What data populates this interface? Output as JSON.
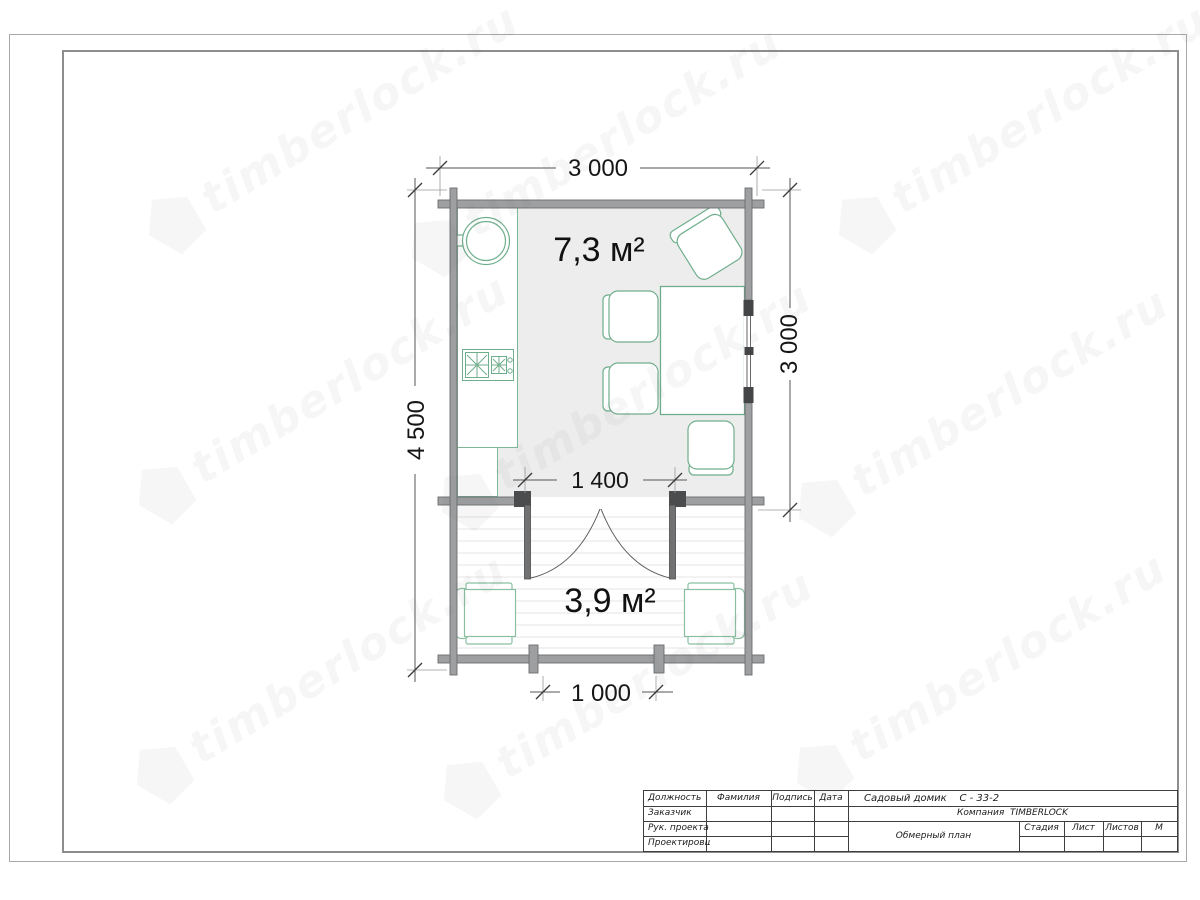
{
  "watermark": {
    "text": "timberlock.ru"
  },
  "plan": {
    "dim_width_top": "3 000",
    "dim_height_total": "4 500",
    "dim_height_room": "3 000",
    "dim_door_opening": "1 400",
    "dim_terrace_opening": "1 000",
    "area_room": "7,3 м²",
    "area_terrace": "3,9 м²"
  },
  "title_block": {
    "col_position": "Должность",
    "col_surname": "Фамилия",
    "col_signature": "Подпись",
    "col_date": "Дата",
    "row_customer": "Заказчик",
    "row_project_lead": "Рук. проекта",
    "row_designer": "Проектировщик",
    "project_title": "Садовый домик    С - 33-2",
    "company": "Компания  TIMBERLOCK",
    "drawing_type": "Обмерный план",
    "col_stage": "Стадия",
    "col_sheet": "Лист",
    "col_sheets": "Листов",
    "col_scale": "М"
  },
  "colors": {
    "wall_fill": "#9d9fa1",
    "wall_edge": "#6b6d6f",
    "furniture_green": "#6fae8c",
    "armchair_green": "#8abfa0",
    "room_fill": "#ededee",
    "door_dark": "#4a4c4e",
    "dim_line": "#555555",
    "text_dark": "#161616"
  }
}
